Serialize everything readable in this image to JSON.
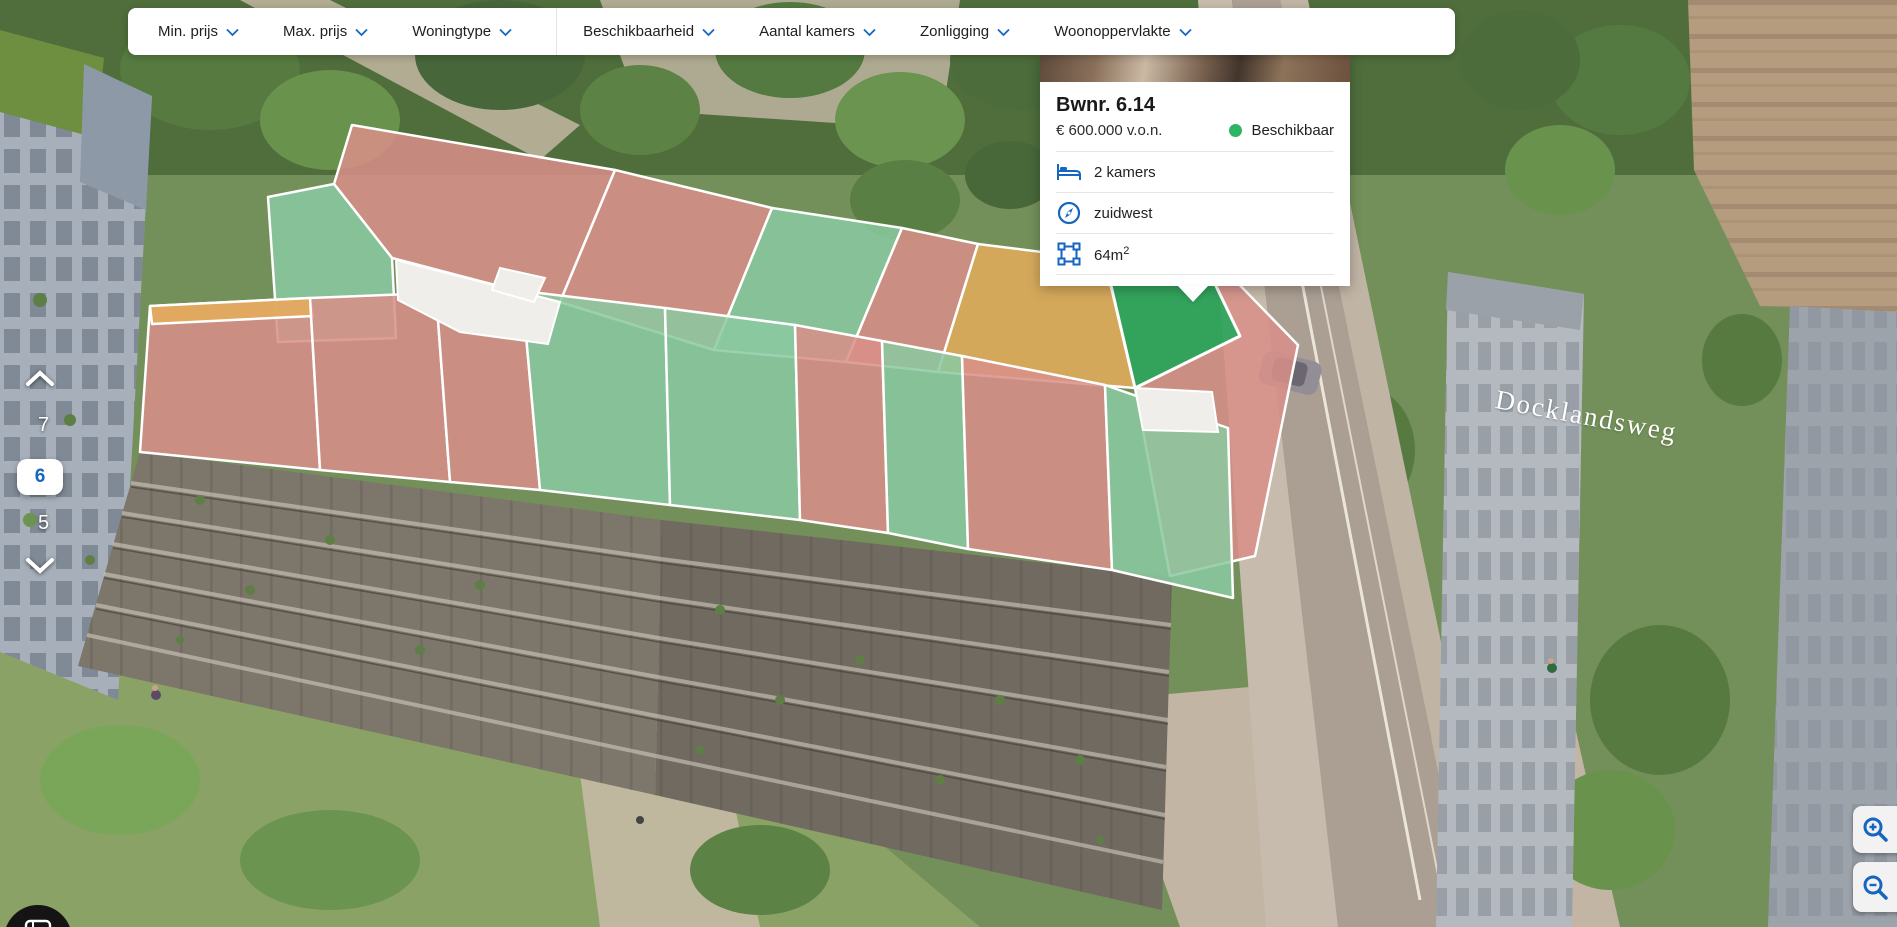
{
  "filter_bar": {
    "groups": [
      {
        "items": [
          {
            "name": "min-prijs",
            "label": "Min. prijs"
          },
          {
            "name": "max-prijs",
            "label": "Max. prijs"
          },
          {
            "name": "woningtype",
            "label": "Woningtype"
          }
        ]
      },
      {
        "items": [
          {
            "name": "beschikbaarheid",
            "label": "Beschikbaarheid"
          },
          {
            "name": "aantal-kamers",
            "label": "Aantal kamers"
          },
          {
            "name": "zonligging",
            "label": "Zonligging"
          },
          {
            "name": "woonoppervlakte",
            "label": "Woonoppervlakte"
          }
        ]
      }
    ]
  },
  "tooltip": {
    "title": "Bwnr. 6.14",
    "price": "€ 600.000 v.o.n.",
    "status": "Beschikbaar",
    "rooms": "2 kamers",
    "orientation": "zuidwest",
    "area_base": "64m",
    "area_exponent": "2"
  },
  "floor_selector": {
    "upper": "7",
    "selected": "6",
    "lower": "5"
  },
  "scene": {
    "street_label": "Docklandsweg"
  },
  "colors": {
    "accent_blue": "#1666C0",
    "status_green": "#2DB563",
    "unit_sold": "#D98F88",
    "unit_available": "#8BC9A1",
    "unit_option": "#E4AC5B",
    "unit_selected": "#2FA45C"
  },
  "units": [
    {
      "status": "verkocht",
      "points": "352,125 615,170 560,302 392,258 334,184"
    },
    {
      "status": "beschikbaar",
      "points": "268,197 334,184 392,258 396,338 278,342"
    },
    {
      "status": "verkocht",
      "points": "615,170 772,208 714,350 560,302"
    },
    {
      "status": "beschikbaar",
      "points": "772,208 902,228 846,362 714,350"
    },
    {
      "status": "verkocht",
      "points": "902,228 978,244 938,372 846,362"
    },
    {
      "status": "optie",
      "points": "978,244 1105,260 1135,388 938,372"
    },
    {
      "status": "verkocht",
      "points": "1192,236 1298,345 1255,556 1170,576 1135,388 1240,336"
    },
    {
      "status": "geselecteerd",
      "points": "1105,260 1192,236 1240,336 1135,388"
    },
    {
      "status": "verkocht",
      "points": "150,306 310,298 320,470 140,452"
    },
    {
      "status": "optie",
      "points": "150,306 310,298 313,316 152,324"
    },
    {
      "status": "verkocht",
      "points": "310,298 436,293 450,482 320,470"
    },
    {
      "status": "verkocht",
      "points": "436,293 522,291 540,490 450,482"
    },
    {
      "status": "beschikbaar",
      "points": "522,291 665,308 670,505 540,490"
    },
    {
      "status": "beschikbaar",
      "points": "665,308 795,325 800,520 670,505"
    },
    {
      "status": "verkocht",
      "points": "795,325 882,341 888,533 800,520"
    },
    {
      "status": "beschikbaar",
      "points": "882,341 962,356 968,549 888,533"
    },
    {
      "status": "verkocht",
      "points": "962,356 1105,385 1112,570 968,549"
    },
    {
      "status": "beschikbaar",
      "points": "1105,385 1228,428 1233,598 1112,570"
    }
  ]
}
